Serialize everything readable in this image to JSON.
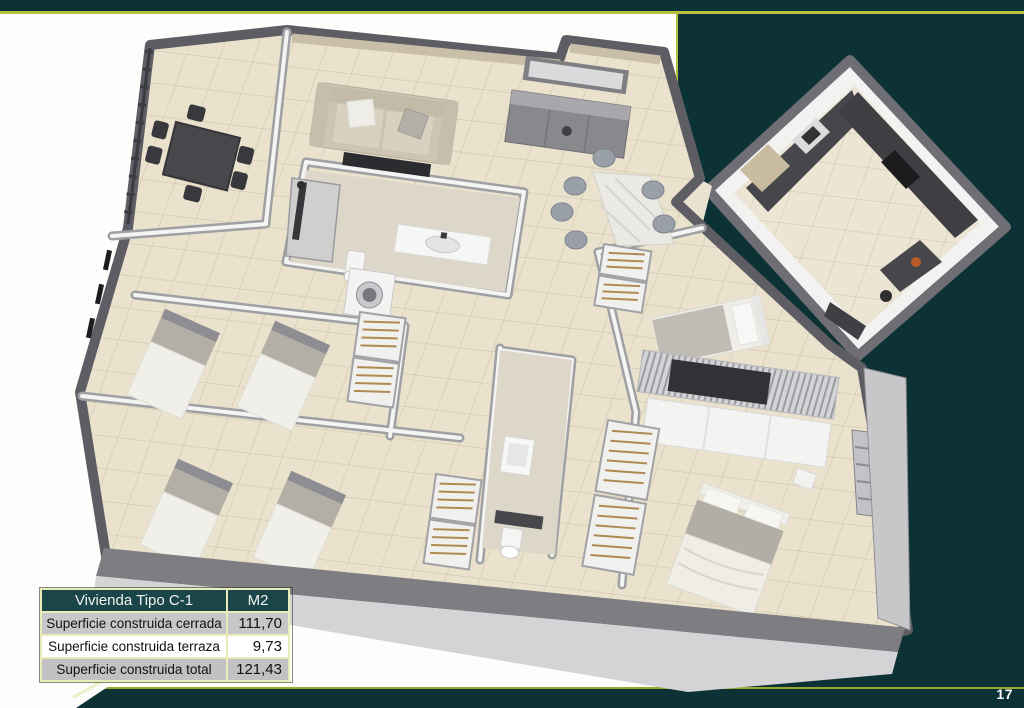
{
  "slide": {
    "page_number": "17"
  },
  "colors": {
    "background": "#0d3236",
    "accent_line": "#b6c23d",
    "pale_border": "#e9ecb6",
    "table_header_bg": "#1b4649"
  },
  "table": {
    "header": {
      "title": "Vivienda Tipo C-1",
      "unit": "M2"
    },
    "rows": [
      {
        "label": "Superficie construida cerrada",
        "value": "111,70"
      },
      {
        "label": "Superficie construida terraza",
        "value": "9,73"
      },
      {
        "label": "Superficie construida total",
        "value": "121,43"
      }
    ]
  },
  "floorplan": {
    "alt": "3D isometric cutaway render of apartment type C-1 with terrace dining set, living-dining room, separate kitchen block, three bedrooms with beds and open wardrobes, and two bathrooms"
  }
}
